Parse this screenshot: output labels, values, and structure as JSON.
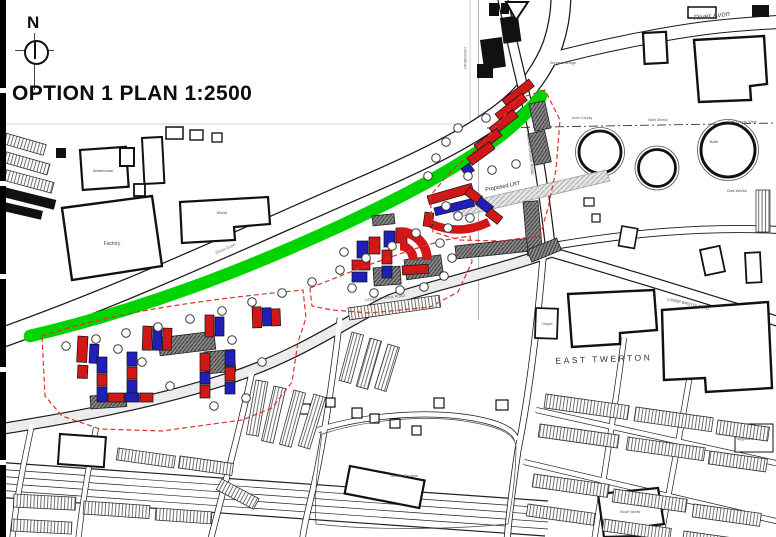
{
  "title": {
    "text": "OPTION 1 PLAN 1:2500"
  },
  "compass": {
    "north_label": "N"
  },
  "colors": {
    "riverside_green": "#00d400",
    "proposed_red": "#d01818",
    "proposed_blue": "#2020b8",
    "boundary_red": "#e03030",
    "retained_gray": "#8a8a8a",
    "linework": "#1a1a1a",
    "paper": "#ffffff"
  },
  "map": {
    "labels": [
      {
        "id": "river-avon-ne",
        "text": "River Avon",
        "x": 712,
        "y": 18,
        "rot": -7,
        "size": 7.5,
        "italic": true,
        "color": "#555"
      },
      {
        "id": "river-avon-mid",
        "text": "River Avon",
        "x": 226,
        "y": 250,
        "rot": -24,
        "size": 4.5,
        "italic": true,
        "color": "#777"
      },
      {
        "id": "east-twerton",
        "text": "EAST TWERTON",
        "x": 604,
        "y": 362,
        "rot": -2,
        "size": 8.5,
        "spacing": 2.5,
        "color": "#333"
      },
      {
        "id": "factory",
        "text": "Factory",
        "x": 112,
        "y": 245,
        "size": 5,
        "color": "#444"
      },
      {
        "id": "warehouse",
        "text": "Warehouse",
        "x": 103,
        "y": 172,
        "size": 4,
        "color": "#444"
      },
      {
        "id": "works",
        "text": "Works",
        "x": 222,
        "y": 214,
        "size": 3.8,
        "color": "#444"
      },
      {
        "id": "gas-works",
        "text": "Gas Works",
        "x": 737,
        "y": 192,
        "size": 4,
        "color": "#444"
      },
      {
        "id": "bath",
        "text": "Bath",
        "x": 714,
        "y": 143,
        "size": 4,
        "color": "#444"
      },
      {
        "id": "proposed-lrt",
        "text": "Proposed LRT",
        "x": 503,
        "y": 188,
        "rot": -11,
        "size": 5.5,
        "color": "#222"
      },
      {
        "id": "windsor-bridge",
        "text": "Windsor Bridge",
        "x": 563,
        "y": 64,
        "size": 3.8,
        "color": "#555"
      },
      {
        "id": "windsor-bridge-road",
        "text": "WINDSOR BRIDGE ROAD",
        "x": 529,
        "y": 152,
        "rot": 84,
        "size": 3.8,
        "color": "#444"
      },
      {
        "id": "lower-bristol-road-e",
        "text": "LOWER BRISTOL ROAD",
        "x": 688,
        "y": 305,
        "rot": 13,
        "size": 3.8,
        "color": "#444"
      },
      {
        "id": "lower-bristol-road-w",
        "text": "LOWER BRISTOL ROAD",
        "x": 385,
        "y": 299,
        "rot": -7,
        "size": 3.6,
        "color": "#555"
      },
      {
        "id": "longmead",
        "text": "LONGMEAD",
        "x": 464,
        "y": 58,
        "rot": 90,
        "size": 3.8,
        "color": "#555"
      },
      {
        "id": "playground",
        "text": "Playground",
        "x": 744,
        "y": 440,
        "size": 3.8,
        "color": "#555"
      },
      {
        "id": "norfolk-gardens",
        "text": "Norfolk Gardens",
        "x": 404,
        "y": 477,
        "size": 3.8,
        "color": "#555"
      },
      {
        "id": "avon-county",
        "text": "Avon County",
        "x": 582,
        "y": 119,
        "size": 3.6,
        "color": "#555"
      },
      {
        "id": "bath-district",
        "text": "Bath District",
        "x": 658,
        "y": 121,
        "size": 3.6,
        "color": "#555"
      },
      {
        "id": "bath-county-west",
        "text": "Bath County West",
        "x": 742,
        "y": 123,
        "size": 3.6,
        "color": "#555"
      },
      {
        "id": "stuart-works",
        "text": "Stuart Works",
        "x": 630,
        "y": 513,
        "size": 3.6,
        "color": "#555"
      },
      {
        "id": "chapel",
        "text": "Chapel",
        "x": 547,
        "y": 325,
        "size": 3.4,
        "color": "#555"
      }
    ]
  }
}
